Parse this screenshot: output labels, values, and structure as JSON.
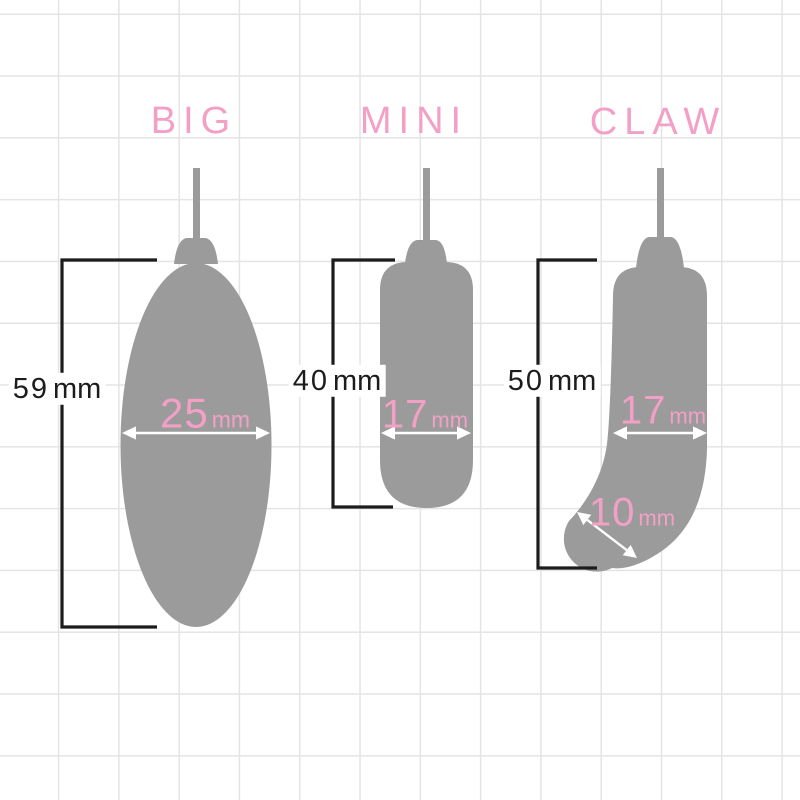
{
  "diagram_title": "Size comparison of three egg-shaped devices",
  "colors": {
    "pink": "#f3a0c6",
    "gray": "#9b9b9b",
    "ink": "#1c1c1c",
    "grid": "#e4e4e4",
    "bg": "#ffffff",
    "arrow": "#ffffff"
  },
  "products": [
    {
      "label": "BIG",
      "height": {
        "value": "59",
        "unit": "mm"
      },
      "width": {
        "value": "25",
        "unit": "mm"
      }
    },
    {
      "label": "MINI",
      "height": {
        "value": "40",
        "unit": "mm"
      },
      "width": {
        "value": "17",
        "unit": "mm"
      }
    },
    {
      "label": "CLAW",
      "height": {
        "value": "50",
        "unit": "mm"
      },
      "width": {
        "value": "17",
        "unit": "mm"
      },
      "tip": {
        "value": "10",
        "unit": "mm"
      }
    }
  ]
}
